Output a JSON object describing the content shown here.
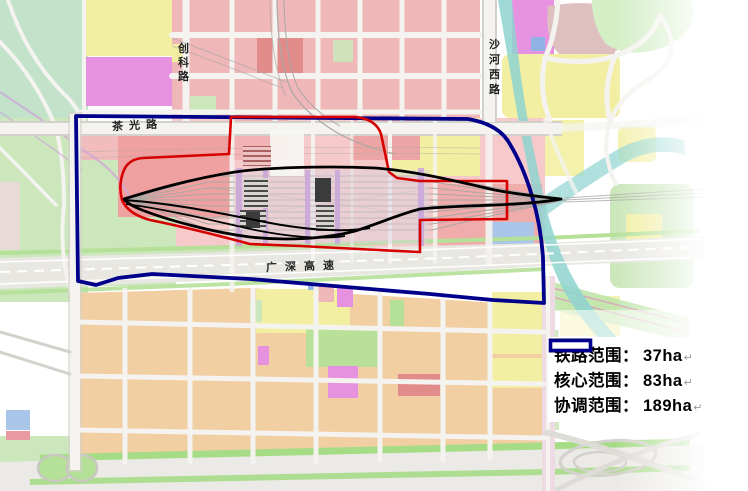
{
  "map": {
    "road_labels": {
      "chuangke_lu": "创科路",
      "chaguang_lu": "茶光路",
      "shahe_xi_lu": "沙河西路",
      "guangshen_expressway": "广深高速"
    },
    "colors": {
      "railway_boundary": "#000000",
      "core_boundary": "#d60000",
      "coordination_boundary": "#00008b",
      "river": "#8ed4d0",
      "residential_orange": "#f1cfa3",
      "commercial_pink": "#efb7b7",
      "industrial_yellow": "#f2efa3",
      "green_space": "#cbe7bb",
      "special_magenta": "#e792e0"
    }
  },
  "legend": {
    "items": [
      {
        "id": "railway",
        "label": "铁路范围：",
        "value": "37ha",
        "color": "#000000"
      },
      {
        "id": "core",
        "label": "核心范围：",
        "value": "83ha",
        "color": "#d60000"
      },
      {
        "id": "coordination",
        "label": "协调范围：",
        "value": "189ha",
        "color": "#00008b"
      }
    ],
    "return_mark": "↵"
  }
}
